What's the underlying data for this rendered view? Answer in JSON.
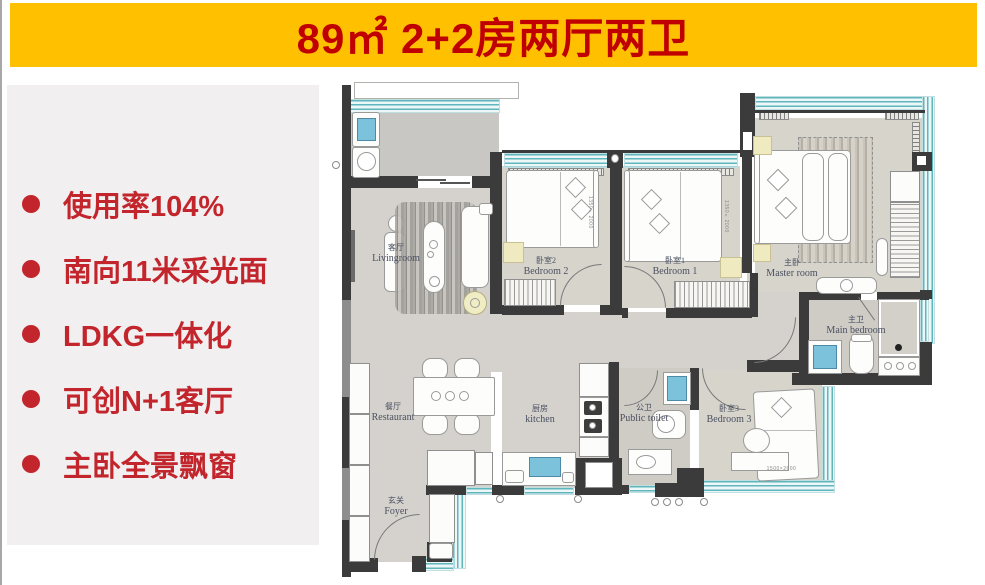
{
  "banner": {
    "title": "89㎡ 2+2房两厅两卫"
  },
  "features": [
    {
      "text": "使用率104%"
    },
    {
      "text": "南向11米采光面"
    },
    {
      "text": "LDKG一体化"
    },
    {
      "text": "可创N+1客厅"
    },
    {
      "text": "主卧全景飘窗"
    }
  ],
  "plan": {
    "rooms": {
      "living": {
        "cn": "客厅",
        "en": "Livingroom"
      },
      "dining": {
        "cn": "餐厅",
        "en": "Restaurant"
      },
      "foyer": {
        "cn": "玄关",
        "en": "Foyer"
      },
      "kitchen": {
        "cn": "厨房",
        "en": "kitchen"
      },
      "public_toilet": {
        "cn": "公卫",
        "en": "Public toilet"
      },
      "bedroom2": {
        "cn": "卧室2",
        "en": "Bedroom 2"
      },
      "bedroom1": {
        "cn": "卧室1",
        "en": "Bedroom 1"
      },
      "master": {
        "cn": "主卧",
        "en": "Master room"
      },
      "master_bath": {
        "cn": "主卫",
        "en": "Main bedroom"
      },
      "bedroom3": {
        "cn": "卧室3",
        "en": "Bedroom 3"
      }
    },
    "dimensions": {
      "bed2": "1350×2000",
      "bed1": "1350×2000",
      "bed3": "1500×2600"
    }
  },
  "colors": {
    "banner_bg": "#FFC000",
    "banner_text": "#C00000",
    "feature_text": "#C2262C",
    "panel_bg": "#F1EFF0",
    "wall": "#3B3B3B",
    "window_teal": "#5FB6BC",
    "floor": "#D5D2CD",
    "shower_blue": "#7CC2DA",
    "accent_rug_yellow": "#EFEABF"
  }
}
